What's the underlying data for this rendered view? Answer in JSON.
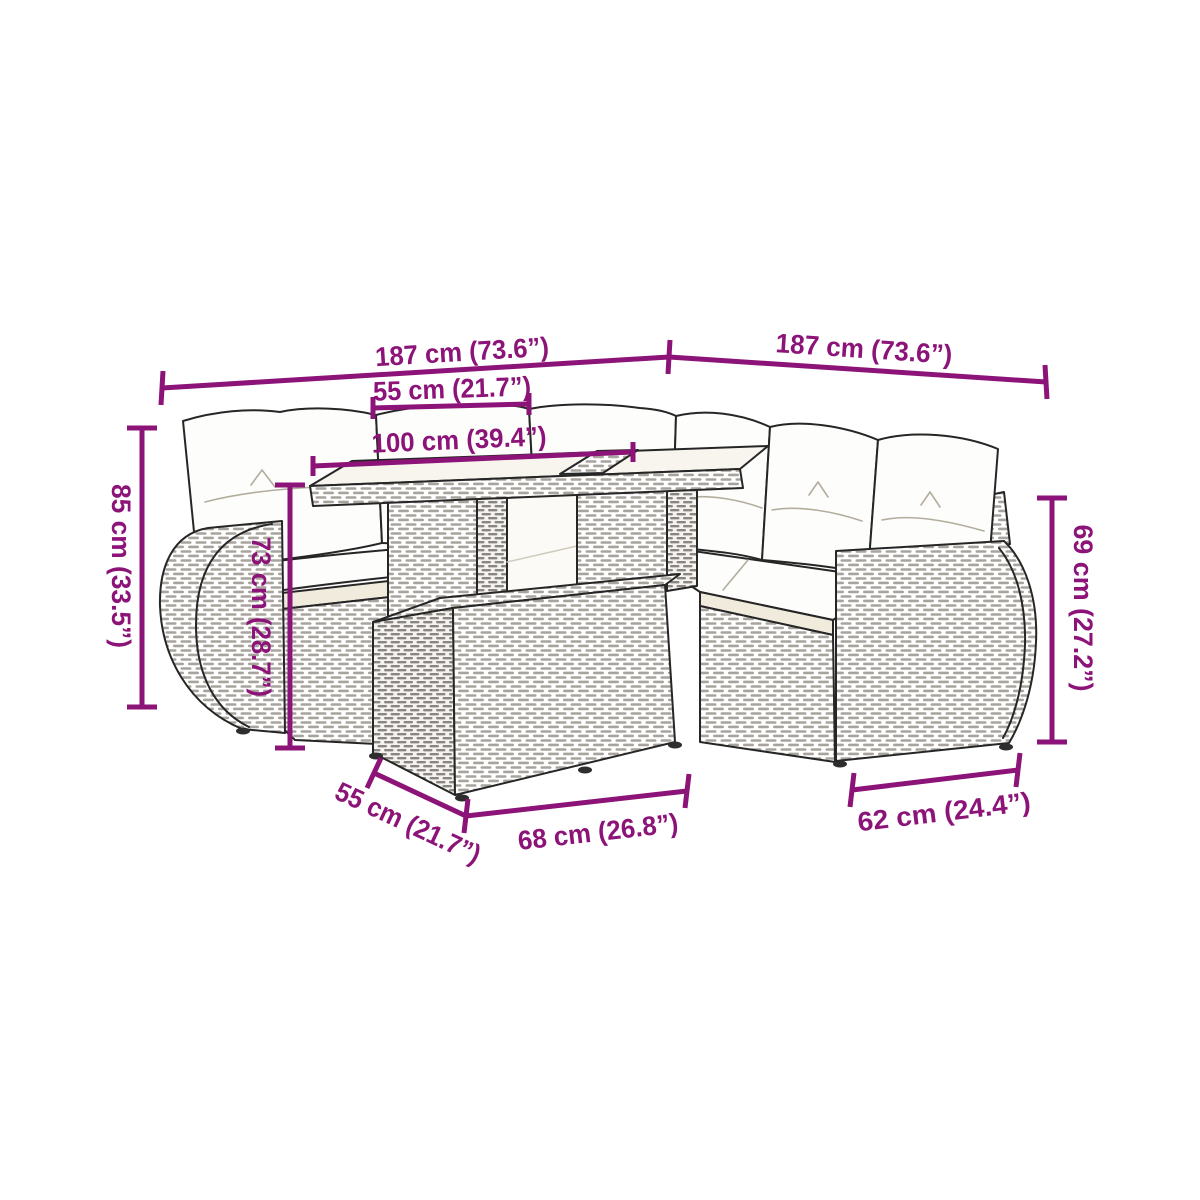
{
  "colors": {
    "background": "#ffffff",
    "dimension_annotation": "#8c1377",
    "line_art": "#262626",
    "cushion_white": "#fdfdfb",
    "cushion_front": "#f0ebdc",
    "table_top": "#f7f5ed"
  },
  "dimensions": [
    {
      "position": "top-left",
      "label": "187 cm (73.6”)"
    },
    {
      "position": "top-right",
      "label": "187 cm (73.6”)"
    },
    {
      "position": "upper-middle",
      "label": "55 cm (21.7”)"
    },
    {
      "position": "middle",
      "label": "100 cm (39.4”)"
    },
    {
      "position": "left-vertical",
      "label": "85 cm (33.5”)"
    },
    {
      "position": "inner-left-vertical",
      "label": "73 cm (28.7”)"
    },
    {
      "position": "right-vertical",
      "label": "69 cm (27.2”)"
    },
    {
      "position": "bottom-left-diagonal",
      "label": "55 cm (21.7”)"
    },
    {
      "position": "bottom-middle",
      "label": "68 cm (26.8”)"
    },
    {
      "position": "bottom-right",
      "label": "62 cm (24.4”)"
    }
  ]
}
